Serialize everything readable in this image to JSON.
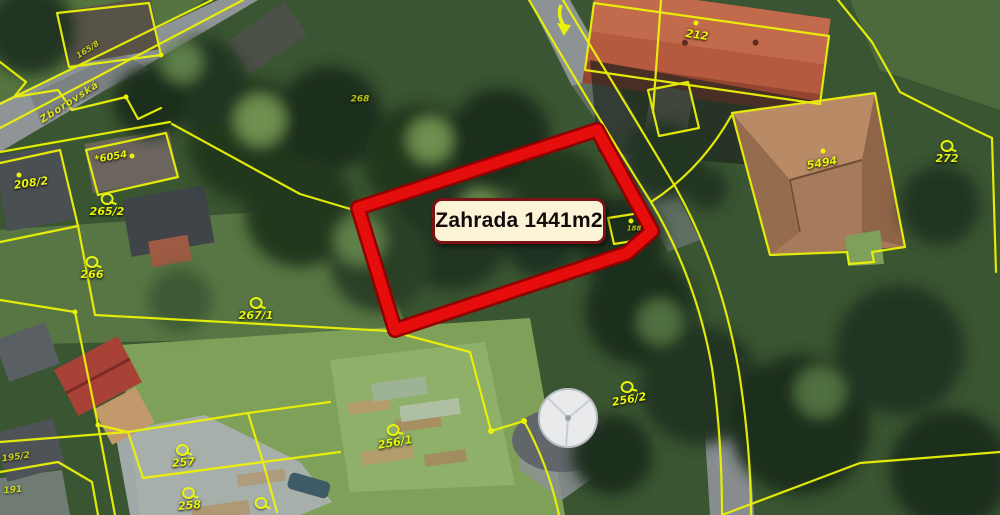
{
  "map": {
    "highlight": {
      "label": "Zahrada 1441m2"
    },
    "street": {
      "name": "Zborovská",
      "x": 70,
      "y": 103,
      "rot": -33,
      "size": 10
    },
    "parcel_labels": [
      {
        "text": "165/8",
        "x": 88,
        "y": 50,
        "symbol": "none",
        "rot": -33,
        "size": 8,
        "cls": "faint"
      },
      {
        "text": "208/2",
        "x": 31,
        "y": 183,
        "symbol": "none",
        "rot": -8,
        "size": 11
      },
      {
        "text": "*6054",
        "x": 111,
        "y": 158,
        "symbol": "none",
        "rot": -10,
        "size": 10
      },
      {
        "text": "265/2",
        "x": 107,
        "y": 205,
        "symbol": "garden",
        "rot": 0,
        "size": 11
      },
      {
        "text": "266",
        "x": 92,
        "y": 268,
        "symbol": "garden",
        "rot": 0,
        "size": 11
      },
      {
        "text": "267/1",
        "x": 256,
        "y": 309,
        "symbol": "garden",
        "rot": 0,
        "size": 11
      },
      {
        "text": "268",
        "x": 360,
        "y": 100,
        "symbol": "none",
        "rot": 0,
        "size": 9,
        "cls": "faint"
      },
      {
        "text": "212",
        "x": 697,
        "y": 35,
        "symbol": "none",
        "rot": 8,
        "size": 11
      },
      {
        "text": "5494",
        "x": 822,
        "y": 163,
        "symbol": "none",
        "rot": -10,
        "size": 11
      },
      {
        "text": "272",
        "x": 947,
        "y": 152,
        "symbol": "garden",
        "rot": 0,
        "size": 11
      },
      {
        "text": "188",
        "x": 634,
        "y": 229,
        "symbol": "none",
        "rot": 0,
        "size": 7,
        "cls": "faint"
      },
      {
        "text": "256/2",
        "x": 628,
        "y": 393,
        "symbol": "garden",
        "rot": -10,
        "size": 11
      },
      {
        "text": "256/1",
        "x": 394,
        "y": 436,
        "symbol": "garden",
        "rot": -10,
        "size": 11
      },
      {
        "text": "257",
        "x": 183,
        "y": 456,
        "symbol": "garden",
        "rot": -5,
        "size": 11
      },
      {
        "text": "258",
        "x": 189,
        "y": 499,
        "symbol": "garden",
        "rot": -5,
        "size": 11
      },
      {
        "text": "",
        "x": 261,
        "y": 503,
        "symbol": "garden",
        "rot": 0,
        "size": 11
      },
      {
        "text": "195/2",
        "x": 16,
        "y": 458,
        "symbol": "none",
        "rot": -8,
        "size": 9,
        "cls": "faint"
      },
      {
        "text": "191",
        "x": 13,
        "y": 491,
        "symbol": "none",
        "rot": -5,
        "size": 9,
        "cls": "faint"
      }
    ],
    "colors": {
      "cadastral_yellow": "#ecf207",
      "highlight_red": "#e60d0d",
      "highlight_rim": "#920000",
      "label_bg": "#fcf4d7",
      "label_border": "#7b1216"
    }
  }
}
